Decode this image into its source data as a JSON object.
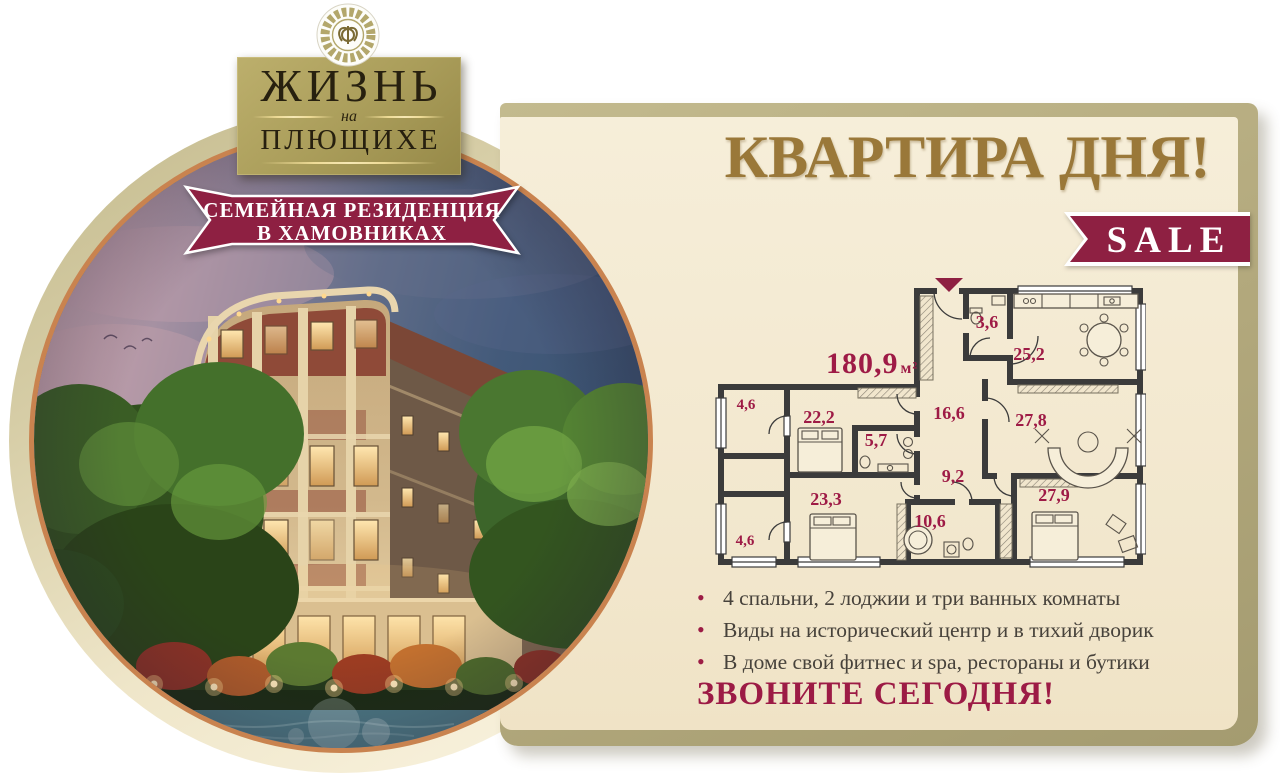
{
  "brand": {
    "ornament_icon": "greek-key-monogram",
    "name_line1": "ЖИЗНЬ",
    "name_preposition": "на",
    "name_line2": "ПЛЮЩИХЕ",
    "tagline_line1": "СЕМЕЙНАЯ РЕЗИДЕНЦИЯ",
    "tagline_line2": "В ХАМОВНИКАХ"
  },
  "promo": {
    "title": "КВАРТИРА ДНЯ!",
    "sale_label": "SALE"
  },
  "floorplan": {
    "total_area_value": "180,9",
    "total_area_unit": "м²",
    "entrance_icon": "entrance-arrow",
    "rooms": [
      {
        "name": "wc",
        "area": "3,6"
      },
      {
        "name": "kitchen-dining",
        "area": "25,2"
      },
      {
        "name": "loggia-top",
        "area": "4,6"
      },
      {
        "name": "bedroom-1",
        "area": "22,2"
      },
      {
        "name": "hall",
        "area": "16,6"
      },
      {
        "name": "living-room",
        "area": "27,8"
      },
      {
        "name": "bathroom-1",
        "area": "5,7"
      },
      {
        "name": "corridor",
        "area": "9,2"
      },
      {
        "name": "bedroom-2",
        "area": "23,3"
      },
      {
        "name": "bathroom-2",
        "area": "10,6"
      },
      {
        "name": "bedroom-3",
        "area": "27,9"
      },
      {
        "name": "loggia-bottom",
        "area": "4,6"
      }
    ]
  },
  "features": {
    "items": [
      "4 спальни, 2 лоджии и три ванных комнаты",
      "Виды на исторический центр и в тихий дворик",
      "В доме свой фитнес и spa, рестораны и бутики"
    ]
  },
  "cta": {
    "label": "ЗВОНИТЕ СЕГОДНЯ!"
  },
  "colors": {
    "maroon_ribbon": "#8e2042",
    "label_maroon": "#9e1b46",
    "gold_title": "#9a7839",
    "plaque_gold": "#ab9e5b",
    "card_beige": "#f3e8d0",
    "card_khaki": "#b5ac80",
    "wall_dark": "#3b3b3b",
    "copper_ring": "#c9834f"
  }
}
